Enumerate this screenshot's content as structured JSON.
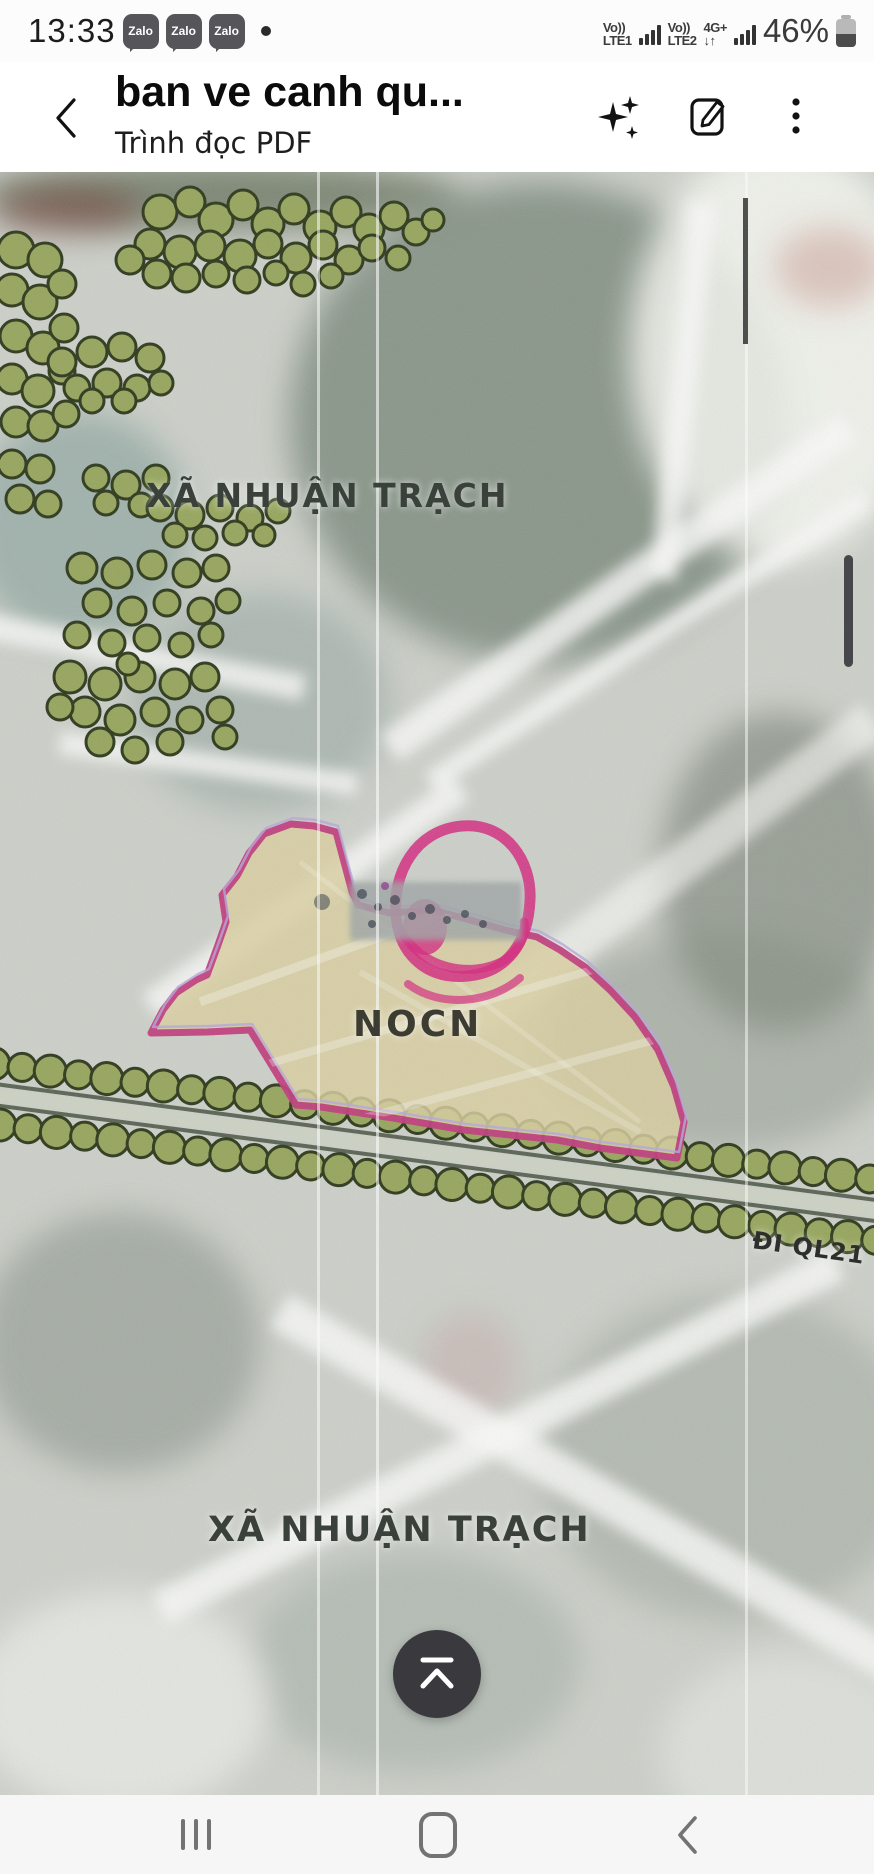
{
  "status_bar": {
    "time": "13:33",
    "zalo_label": "Zalo",
    "sim1_volte": "Vo))",
    "sim1_network": "LTE1",
    "sim2_volte": "Vo))",
    "sim2_network": "LTE2",
    "sim2_speed": "4G+",
    "sim2_arrows": "↓↑",
    "battery_percent": "46%",
    "battery_level": 46
  },
  "header": {
    "title": "ban ve canh qu...",
    "subtitle": "Trình đọc PDF",
    "icons": [
      "back-arrow",
      "ai-sparkle",
      "edit-annotate",
      "more-menu"
    ]
  },
  "map": {
    "labels": {
      "commune_top": "XÃ NHUẬN TRẠCH",
      "area": "NOCN",
      "road": "ĐI QL21",
      "commune_bottom": "XÃ NHUẬN TRẠCH"
    },
    "colors": {
      "polygon_stroke": "#c13f7e",
      "polygon_inner": "#b7a7da",
      "polygon_fill": "#d9cfa0",
      "marker_pink": "#d42b80",
      "tree_fill": "#97a65e",
      "tree_stroke": "#2e3a1c",
      "road_dark": "#46523f",
      "road_light": "#ccd1c3",
      "label_color": "#3a403a",
      "fab_bg": "#3a3a3e"
    }
  },
  "fab": {
    "icon": "scroll-to-top"
  },
  "nav_bar": {
    "icons": [
      "recents",
      "home",
      "back"
    ]
  }
}
